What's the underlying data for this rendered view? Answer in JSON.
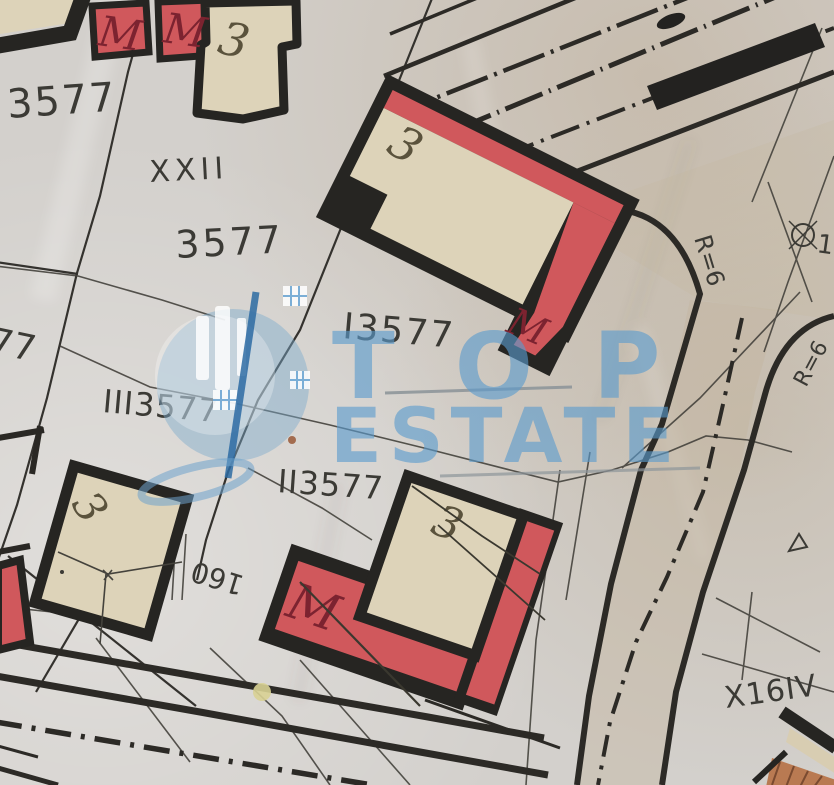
{
  "texts": {
    "parcel_3577_top_left": "3577",
    "block_xxii": "XXII",
    "parcel_3577_center": "3577",
    "parcel_i3577": "I3577",
    "parcel_iii3577": "III3577",
    "parcel_ii3577": "II3577",
    "parcel_77_edge": "77",
    "curve_radius_top": "R=6",
    "curve_radius_right": "R=6",
    "point_number_right": "13",
    "block_x16iv": "X16IV",
    "boundary_length_160": "160",
    "house_top_number": "3",
    "house_center_number": "3",
    "house_bottom_number": "3",
    "house_left_number": "3",
    "m_label_top_left_1": "M",
    "m_label_top_left_2": "M",
    "m_label_center": "M",
    "m_label_bottom": "M"
  },
  "watermark": {
    "word_top": "TOP",
    "word_bottom": "ESTATE"
  },
  "colors": {
    "paper": "#d3d0cc",
    "building_fill": "#ddd3b9",
    "outline_black": "#262522",
    "red_fill": "#d0585c",
    "red_letter": "#7c2330",
    "ink": "#3b3a35",
    "watermark_blue": "#5b9bcd",
    "road_surface_tan": "#c3b49d",
    "terracotta": "#b97a52",
    "highlight_yellow": "#d8d293"
  },
  "symbols": {
    "survey_point_icon": "circle-cross",
    "boundary_triangle_icon": "triangle-outline",
    "road_centerline": "dash-dot"
  }
}
